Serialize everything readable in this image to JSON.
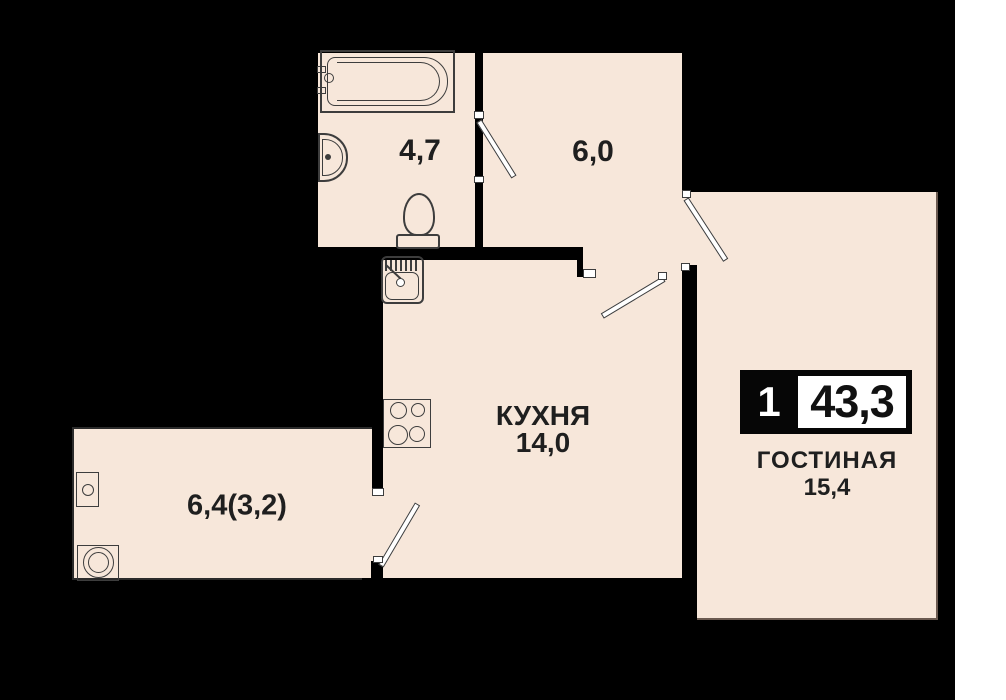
{
  "colors": {
    "background": "#000000",
    "floor": "#f7e7da",
    "stroke": "#3d3d3d",
    "label": "#1f1f1f",
    "badge_bg": "#060606",
    "badge_text": "#ffffff",
    "page_margin": "#ffffff",
    "thin_wall": "#2b2b2b",
    "edge_line": "#6b5a50"
  },
  "badge": {
    "room_count": "1",
    "total_area": "43,3"
  },
  "rooms": {
    "bathroom": {
      "area": "4,7"
    },
    "hallway": {
      "area": "6,0"
    },
    "kitchen": {
      "name": "КУХНЯ",
      "area": "14,0"
    },
    "living": {
      "name": "ГОСТИНАЯ",
      "area": "15,4"
    },
    "balcony": {
      "area": "6,4(3,2)"
    }
  },
  "fixtures": {
    "bathtub": "bathtub-icon",
    "bathroom_sink": "bathroom-sink-icon",
    "toilet": "toilet-icon",
    "kitchen_sink": "kitchen-sink-icon",
    "stove": "stove-icon",
    "washing_machine": "washing-machine-icon",
    "balcony_unit": "balcony-unit-icon"
  }
}
